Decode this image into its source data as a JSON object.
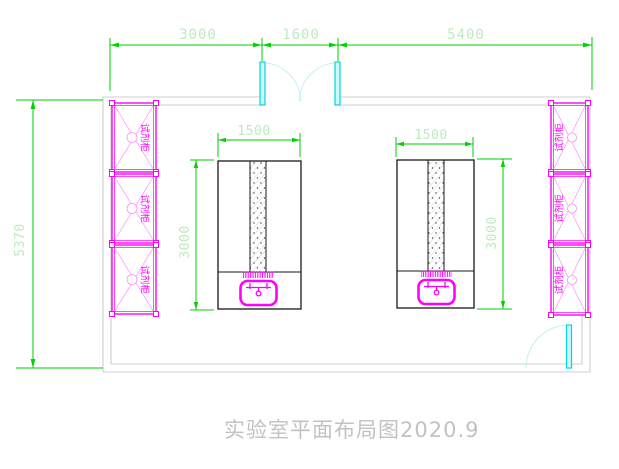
{
  "title": "实验室平面布局图2020.9",
  "dimensions": {
    "top": [
      "3000",
      "1600",
      "5400"
    ],
    "left_overall": "5370",
    "bench_width": "1500",
    "bench_depth": "3000"
  },
  "cabinets": {
    "label": "试剂柜",
    "left_count": 3,
    "right_count": 3
  },
  "colors": {
    "dimension_line": "#00cc00",
    "dimension_text": "#bfeabf",
    "cabinet_magenta": "#ff00ff",
    "door_leaf": "#ccf7f9",
    "door_border": "#00d7e0",
    "door_arc": "#c3eff1",
    "wall_gray": "#cfcfcf",
    "bench_outline": "#1a1a1a",
    "title_text": "#c2c2c2",
    "background": "#ffffff"
  }
}
